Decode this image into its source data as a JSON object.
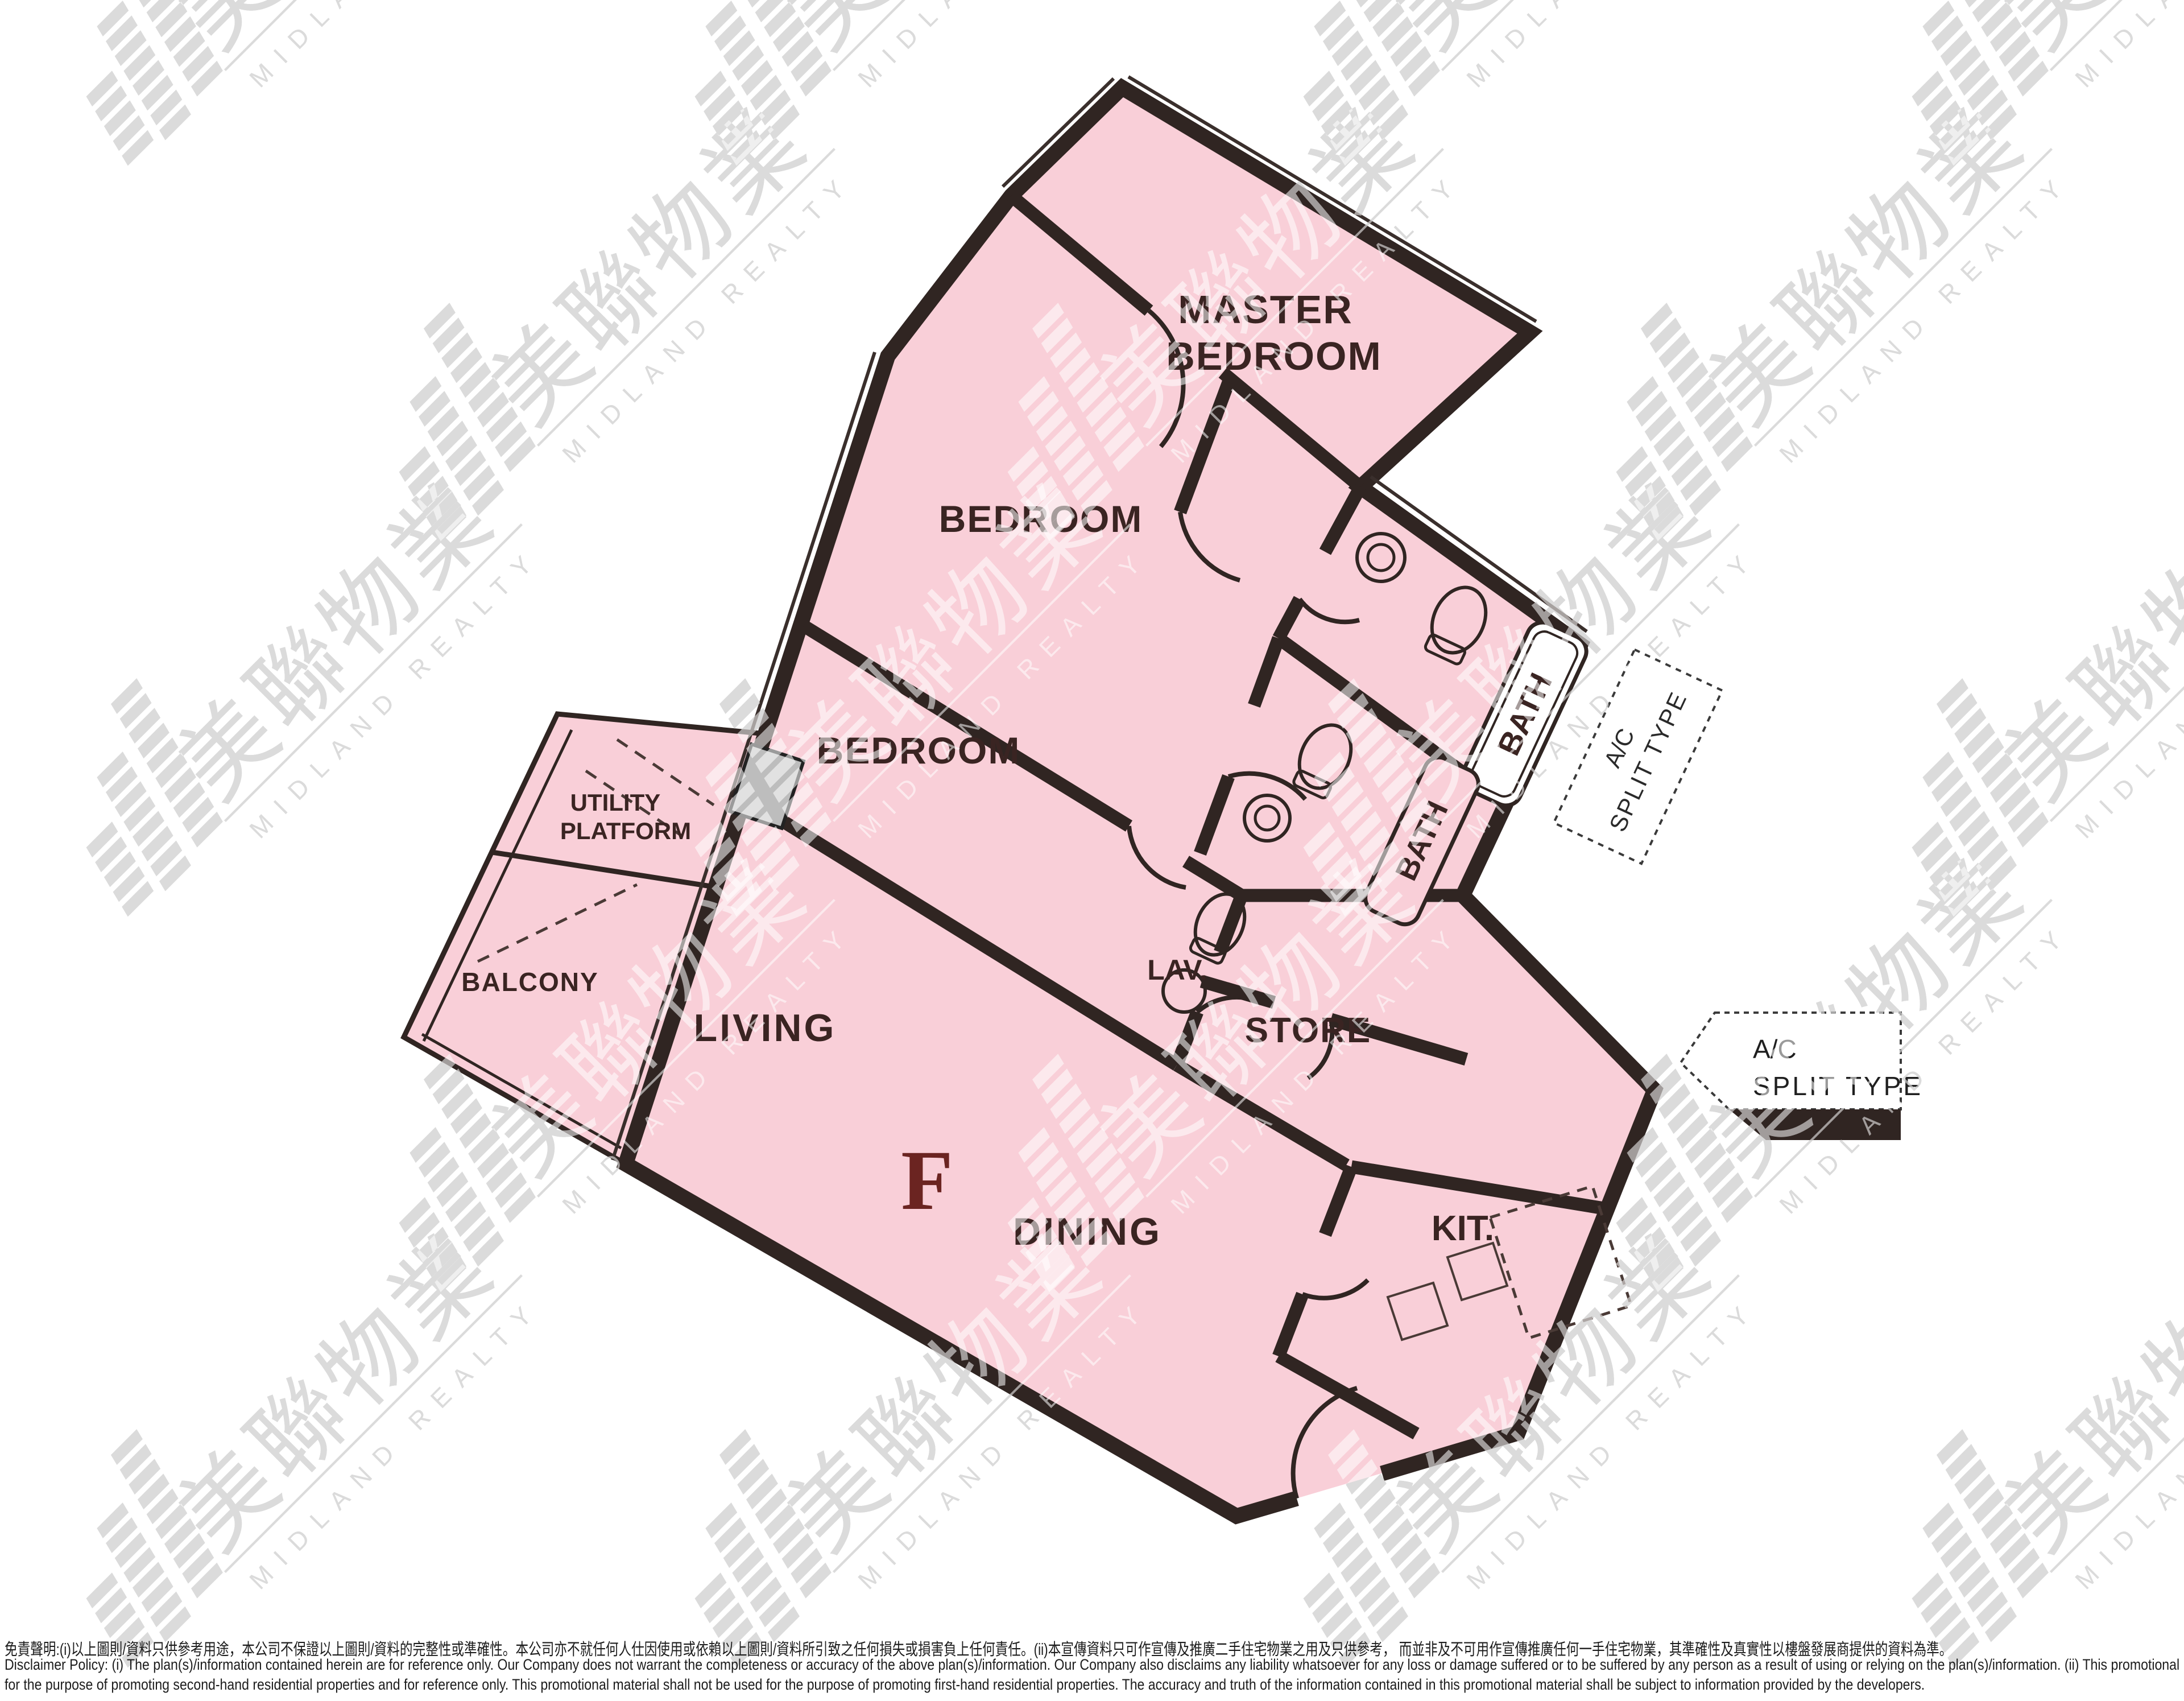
{
  "floor_plan": {
    "unit_letter": "F",
    "rooms": {
      "master_line1": "MASTER",
      "master_line2": "BEDROOM",
      "bedroom": "BEDROOM",
      "living": "LIVING",
      "dining": "DINING",
      "kitchen": "KIT.",
      "store": "STORE",
      "lav": "LAV.",
      "bath": "BATH",
      "balcony": "BALCONY",
      "utility_line1": "UTILITY",
      "utility_line2": "PLATFORM"
    },
    "ac_label": {
      "line1": "A/C",
      "line2": "SPLIT TYPE"
    },
    "colors": {
      "room_fill": "#f9cfd8",
      "wall": "#302522",
      "label_text": "#3a2422",
      "unit_letter": "#6b2421",
      "watermark_gray": "#b0b0b0"
    }
  },
  "watermark": {
    "chinese": "美聯物業",
    "english": "MIDLAND REALTY"
  },
  "disclaimer": {
    "chinese": "免責聲明:(i)以上圖則/資料只供參考用途，本公司不保證以上圖則/資料的完整性或準確性。本公司亦不就任何人仕因使用或依賴以上圖則/資料所引致之任何損失或損害負上任何責任。(ii)本宣傳資料只可作宣傳及推廣二手住宅物業之用及只供參考， 而並非及不可用作宣傳推廣任何一手住宅物業，其準確性及真實性以樓盤發展商提供的資料為準。",
    "english_line1": "Disclaimer Policy: (i) The plan(s)/information contained herein are for reference only. Our Company does not warrant the completeness or accuracy of the above plan(s)/information. Our Company also disclaims any liability whatsoever for any loss or damage suffered or to be suffered by any person as a result of using or relying on the plan(s)/information. (ii) This promotional material is",
    "english_line2": "for the purpose of promoting second-hand residential properties and for reference only. This promotional material shall not be used for the purpose of promoting first-hand residential properties. The accuracy and truth of the information contained in this promotional material shall be subject to information provided by the developers."
  }
}
